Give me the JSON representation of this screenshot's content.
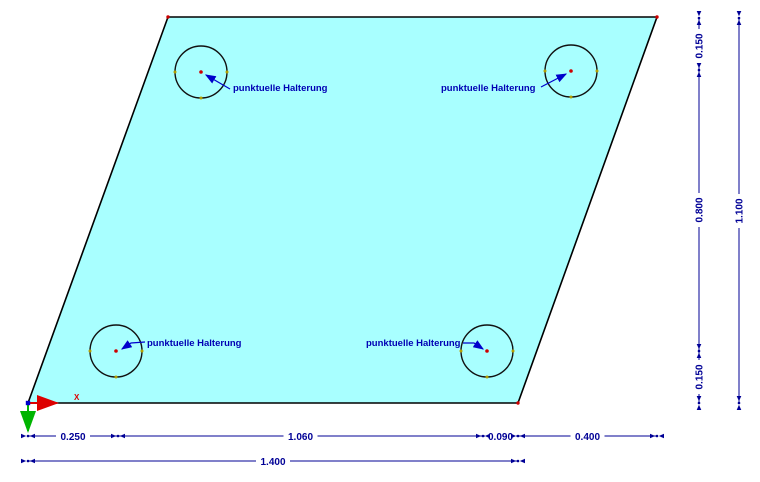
{
  "drawing": {
    "background_color": "#ffffff",
    "plate": {
      "fill_color": "#a8ffff",
      "outline_color": "#000000"
    },
    "supports": {
      "label_color": "#0000b4",
      "items": [
        {
          "label": "punktuelle Halterung"
        },
        {
          "label": "punktuelle Halterung"
        },
        {
          "label": "punktuelle Halterung"
        },
        {
          "label": "punktuelle Halterung"
        }
      ]
    },
    "dimensions": {
      "color": "#000096",
      "bottom_row1": [
        {
          "value": "0.250"
        },
        {
          "value": "1.060"
        },
        {
          "value": "0.090"
        },
        {
          "value": "0.400"
        }
      ],
      "bottom_row2": [
        {
          "value": "1.400"
        }
      ],
      "right_inner": [
        {
          "value": "0.150"
        },
        {
          "value": "0.800"
        },
        {
          "value": "0.150"
        }
      ],
      "right_outer": [
        {
          "value": "1.100"
        }
      ]
    },
    "axes": {
      "x_label": "X",
      "x_color": "#dd0000",
      "y_color": "#00b400"
    }
  }
}
